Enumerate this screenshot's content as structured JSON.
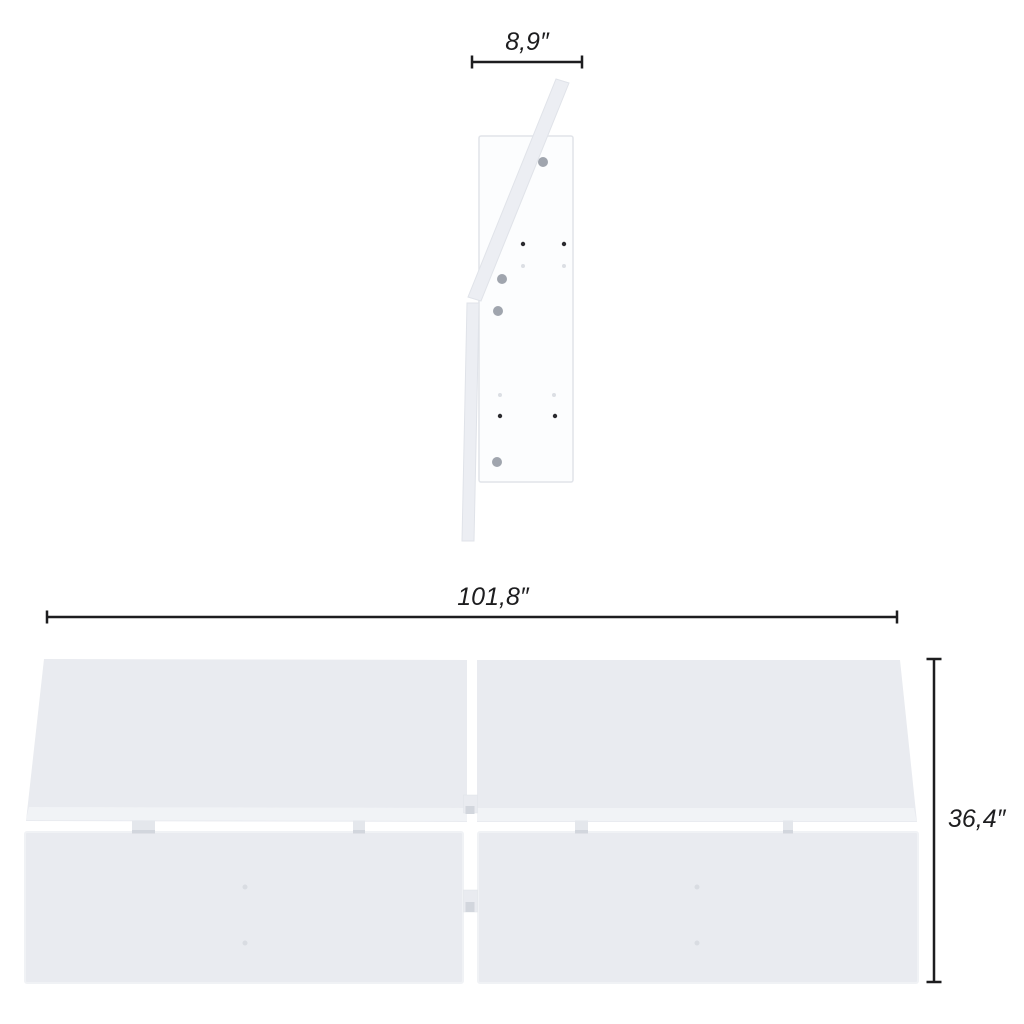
{
  "diagram": {
    "dimensions": {
      "depth_label": "8,9″",
      "width_label": "101,8″",
      "height_label": "36,4″"
    }
  },
  "colors": {
    "background": "#ffffff",
    "dimension_line": "#1d1d1f",
    "panel_fill": "#e9ebf0",
    "panel_edge_highlight": "#f1f3f6",
    "support_panel_fill": "#fcfdfe",
    "support_panel_stroke": "#e1e4e9",
    "board_fill": "#eceef3",
    "board_stroke": "#e0e3e9",
    "hole_fill": "#a0a5ae",
    "hole_dark": "#2b2b2f",
    "hole_faint": "#dcdfe4",
    "tab_fill": "#e4e7ec",
    "tab_shadow": "#d2d6dd",
    "panel_mark": "#d9dce2"
  }
}
